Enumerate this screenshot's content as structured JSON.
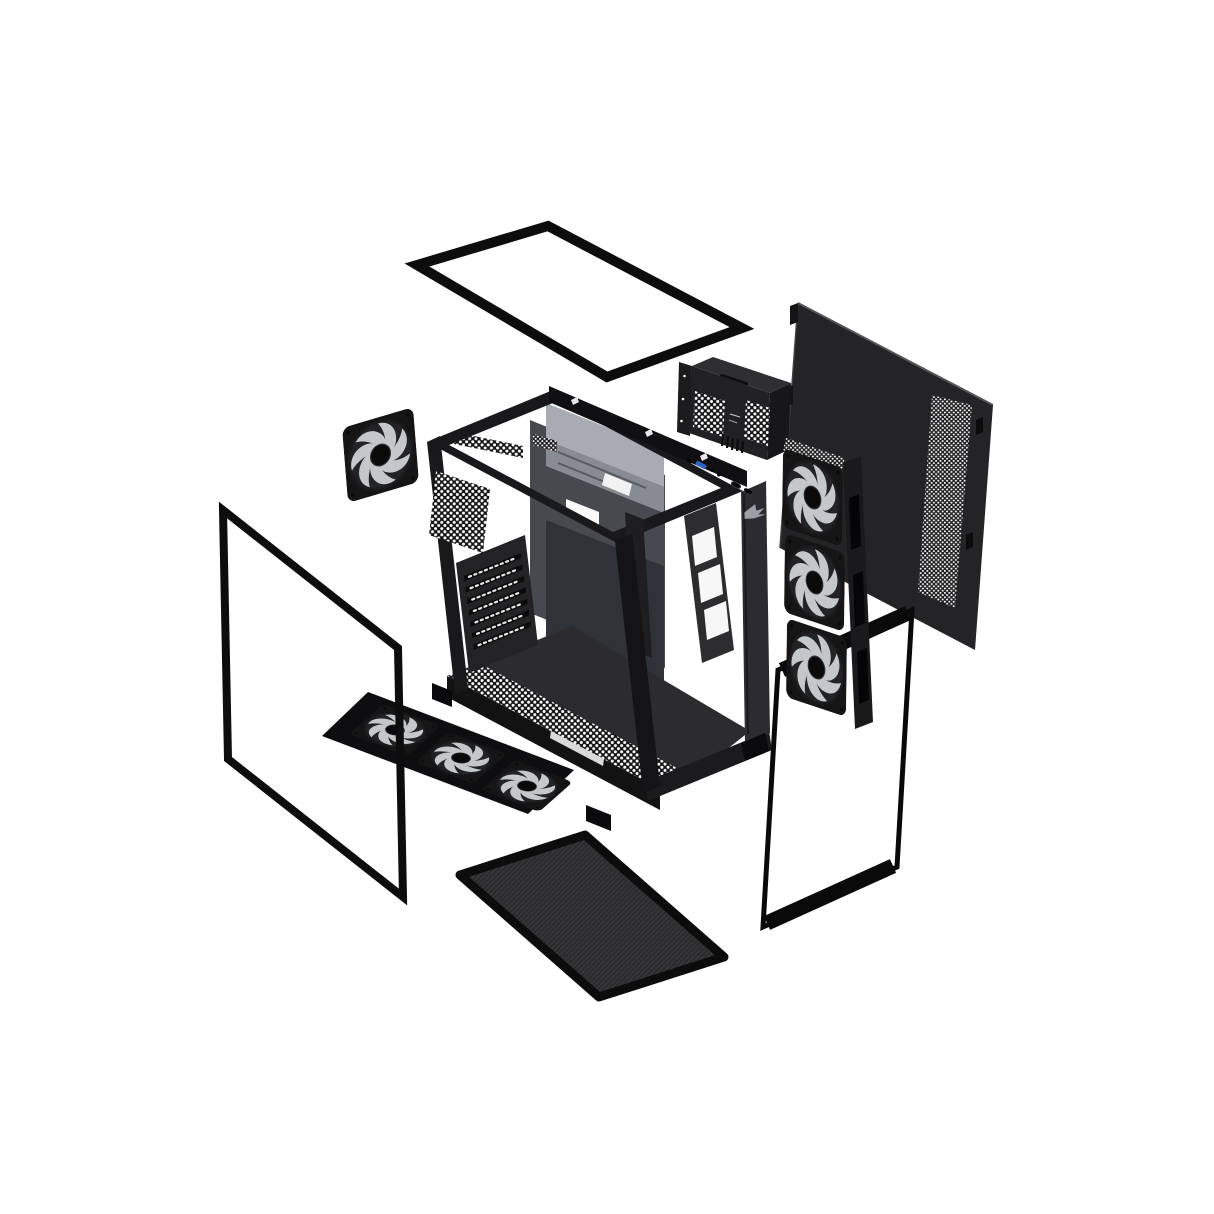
{
  "scene": {
    "name": "pc-case-exploded-view",
    "background": "#ffffff",
    "subject": "Black mid-tower PC case exploded into its panels and parts"
  },
  "colors": {
    "panel_steel": "#242426",
    "glass_frame": "#0d0d0d",
    "chassis_dark": "#19191b",
    "tray_light": "#a6acb1",
    "tray_mid": "#868c91",
    "fan_blade": "#c4c8cb",
    "fan_frame": "#151515",
    "usb_blue": "#2e63c8",
    "logo_gray": "#9aa0a5",
    "filter_mesh": "#2b2b2d",
    "perforation_dot": "#ffffff"
  },
  "parts": {
    "top_glass_panel": "tempered-glass-top-panel",
    "steel_side_panel": "vented-steel-side-panel",
    "psu_bracket": "psu-bracket-cage",
    "rear_exhaust_fan": "120mm-rear-fan",
    "chassis_frame": "open-chassis-frame",
    "pci_slot_count": 7,
    "side_fan_stack": "3x-120mm-side-fans",
    "side_glass_panel": "tempered-glass-side-panel",
    "bottom_fan_row": "3x-120mm-bottom-fans",
    "bottom_dust_filter": "bottom-mesh-dust-filter",
    "front_glass_panel": "tempered-glass-front-panel",
    "io_ports": [
      "usb-c",
      "usb-a",
      "led",
      "audio-jack",
      "power-button",
      "reset-button"
    ],
    "fan_total_count": 7
  }
}
